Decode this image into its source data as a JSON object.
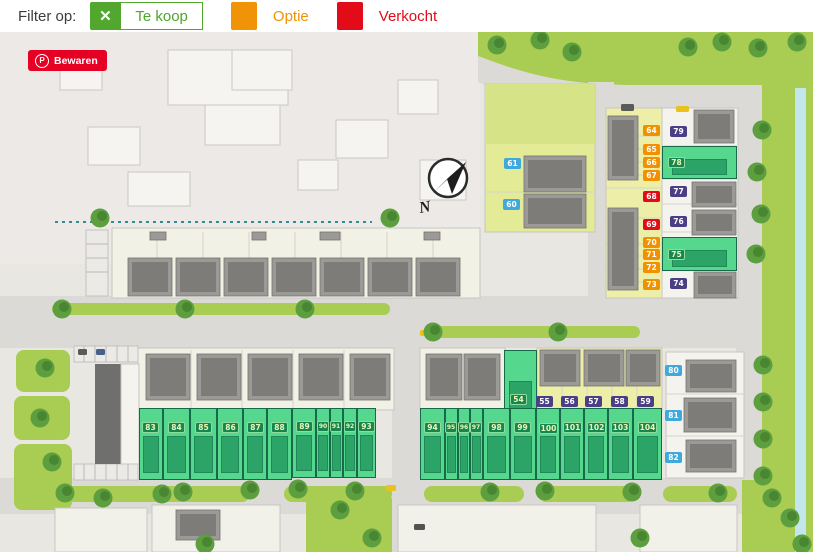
{
  "filter_bar": {
    "label": "Filter op:",
    "legend": [
      {
        "id": "te-koop",
        "label": "Te koop",
        "color": "#52a82e",
        "icon": "x-icon"
      },
      {
        "id": "optie",
        "label": "Optie",
        "color": "#f09307"
      },
      {
        "id": "verkocht",
        "label": "Verkocht",
        "color": "#e30b17"
      }
    ]
  },
  "save_button": {
    "label": "Bewaren",
    "icon": "pinterest-icon",
    "color": "#e60023"
  },
  "compass": {
    "label": "N"
  },
  "badge_colors": {
    "blue": "#3fa9dc",
    "orange": "#f29100",
    "red": "#e30b17",
    "purple": "#4a3f85",
    "green": "#18854f"
  },
  "map": {
    "badges": [
      {
        "n": "61",
        "x": 512,
        "y": 163,
        "status": "blue"
      },
      {
        "n": "60",
        "x": 511,
        "y": 204,
        "status": "blue"
      },
      {
        "n": "80",
        "x": 673,
        "y": 370,
        "status": "blue"
      },
      {
        "n": "81",
        "x": 673,
        "y": 415,
        "status": "blue"
      },
      {
        "n": "82",
        "x": 673,
        "y": 457,
        "status": "blue"
      },
      {
        "n": "64",
        "x": 651,
        "y": 130,
        "status": "orange"
      },
      {
        "n": "65",
        "x": 651,
        "y": 149,
        "status": "orange"
      },
      {
        "n": "66",
        "x": 651,
        "y": 162,
        "status": "orange"
      },
      {
        "n": "67",
        "x": 651,
        "y": 175,
        "status": "orange"
      },
      {
        "n": "68",
        "x": 651,
        "y": 196,
        "status": "red"
      },
      {
        "n": "69",
        "x": 651,
        "y": 224,
        "status": "red"
      },
      {
        "n": "70",
        "x": 651,
        "y": 242,
        "status": "orange"
      },
      {
        "n": "71",
        "x": 651,
        "y": 254,
        "status": "orange"
      },
      {
        "n": "72",
        "x": 651,
        "y": 267,
        "status": "orange"
      },
      {
        "n": "73",
        "x": 651,
        "y": 284,
        "status": "orange"
      },
      {
        "n": "79",
        "x": 678,
        "y": 131,
        "status": "purple"
      },
      {
        "n": "78",
        "x": 676,
        "y": 162,
        "status": "green"
      },
      {
        "n": "77",
        "x": 678,
        "y": 191,
        "status": "purple"
      },
      {
        "n": "76",
        "x": 678,
        "y": 221,
        "status": "purple"
      },
      {
        "n": "75",
        "x": 676,
        "y": 254,
        "status": "green"
      },
      {
        "n": "74",
        "x": 678,
        "y": 283,
        "status": "purple"
      },
      {
        "n": "54",
        "x": 518,
        "y": 399,
        "status": "green"
      },
      {
        "n": "55",
        "x": 544,
        "y": 401,
        "status": "purple"
      },
      {
        "n": "56",
        "x": 569,
        "y": 401,
        "status": "purple"
      },
      {
        "n": "57",
        "x": 593,
        "y": 401,
        "status": "purple"
      },
      {
        "n": "58",
        "x": 619,
        "y": 401,
        "status": "purple"
      },
      {
        "n": "59",
        "x": 645,
        "y": 401,
        "status": "purple"
      },
      {
        "n": "83",
        "x": 150,
        "y": 427,
        "status": "green"
      },
      {
        "n": "84",
        "x": 176,
        "y": 427,
        "status": "green"
      },
      {
        "n": "85",
        "x": 203,
        "y": 427,
        "status": "green"
      },
      {
        "n": "86",
        "x": 230,
        "y": 427,
        "status": "green"
      },
      {
        "n": "87",
        "x": 255,
        "y": 427,
        "status": "green"
      },
      {
        "n": "88",
        "x": 279,
        "y": 427,
        "status": "green"
      },
      {
        "n": "89",
        "x": 304,
        "y": 426,
        "status": "green"
      },
      {
        "n": "90",
        "x": 323,
        "y": 426,
        "status": "green",
        "small": true
      },
      {
        "n": "91",
        "x": 336,
        "y": 426,
        "status": "green",
        "small": true
      },
      {
        "n": "92",
        "x": 350,
        "y": 426,
        "status": "green",
        "small": true
      },
      {
        "n": "93",
        "x": 366,
        "y": 426,
        "status": "green"
      },
      {
        "n": "94",
        "x": 432,
        "y": 427,
        "status": "green"
      },
      {
        "n": "95",
        "x": 451,
        "y": 427,
        "status": "green",
        "small": true
      },
      {
        "n": "96",
        "x": 464,
        "y": 427,
        "status": "green",
        "small": true
      },
      {
        "n": "97",
        "x": 476,
        "y": 427,
        "status": "green",
        "small": true
      },
      {
        "n": "98",
        "x": 496,
        "y": 427,
        "status": "green"
      },
      {
        "n": "99",
        "x": 522,
        "y": 427,
        "status": "green"
      },
      {
        "n": "100",
        "x": 548,
        "y": 428,
        "status": "green"
      },
      {
        "n": "101",
        "x": 572,
        "y": 427,
        "status": "green"
      },
      {
        "n": "102",
        "x": 596,
        "y": 427,
        "status": "green"
      },
      {
        "n": "103",
        "x": 620,
        "y": 427,
        "status": "green"
      },
      {
        "n": "104",
        "x": 647,
        "y": 427,
        "status": "green"
      }
    ],
    "green_plots": [
      {
        "n": "78",
        "x": 662,
        "y": 146,
        "w": 75,
        "h": 33
      },
      {
        "n": "75",
        "x": 662,
        "y": 237,
        "w": 75,
        "h": 34
      },
      {
        "n": "54",
        "x": 504,
        "y": 350,
        "w": 33,
        "h": 82
      },
      {
        "n": "83",
        "x": 139,
        "y": 408,
        "w": 24,
        "h": 72
      },
      {
        "n": "84",
        "x": 163,
        "y": 408,
        "w": 27,
        "h": 72
      },
      {
        "n": "85",
        "x": 190,
        "y": 408,
        "w": 27,
        "h": 72
      },
      {
        "n": "86",
        "x": 217,
        "y": 408,
        "w": 26,
        "h": 72
      },
      {
        "n": "87",
        "x": 243,
        "y": 408,
        "w": 24,
        "h": 72
      },
      {
        "n": "88",
        "x": 267,
        "y": 408,
        "w": 25,
        "h": 72
      },
      {
        "n": "89",
        "x": 292,
        "y": 408,
        "w": 24,
        "h": 70
      },
      {
        "n": "90",
        "x": 316,
        "y": 408,
        "w": 14,
        "h": 70
      },
      {
        "n": "91",
        "x": 330,
        "y": 408,
        "w": 13,
        "h": 70
      },
      {
        "n": "92",
        "x": 343,
        "y": 408,
        "w": 14,
        "h": 70
      },
      {
        "n": "93",
        "x": 357,
        "y": 408,
        "w": 19,
        "h": 70
      },
      {
        "n": "94",
        "x": 420,
        "y": 408,
        "w": 25,
        "h": 72
      },
      {
        "n": "95",
        "x": 445,
        "y": 408,
        "w": 13,
        "h": 72
      },
      {
        "n": "96",
        "x": 458,
        "y": 408,
        "w": 12,
        "h": 72
      },
      {
        "n": "97",
        "x": 470,
        "y": 408,
        "w": 13,
        "h": 72
      },
      {
        "n": "98",
        "x": 483,
        "y": 408,
        "w": 27,
        "h": 72
      },
      {
        "n": "99",
        "x": 510,
        "y": 408,
        "w": 26,
        "h": 72
      },
      {
        "n": "100",
        "x": 536,
        "y": 408,
        "w": 24,
        "h": 72
      },
      {
        "n": "101",
        "x": 560,
        "y": 408,
        "w": 24,
        "h": 72
      },
      {
        "n": "102",
        "x": 584,
        "y": 408,
        "w": 24,
        "h": 72
      },
      {
        "n": "103",
        "x": 608,
        "y": 408,
        "w": 25,
        "h": 72
      },
      {
        "n": "104",
        "x": 633,
        "y": 408,
        "w": 29,
        "h": 72
      }
    ]
  }
}
